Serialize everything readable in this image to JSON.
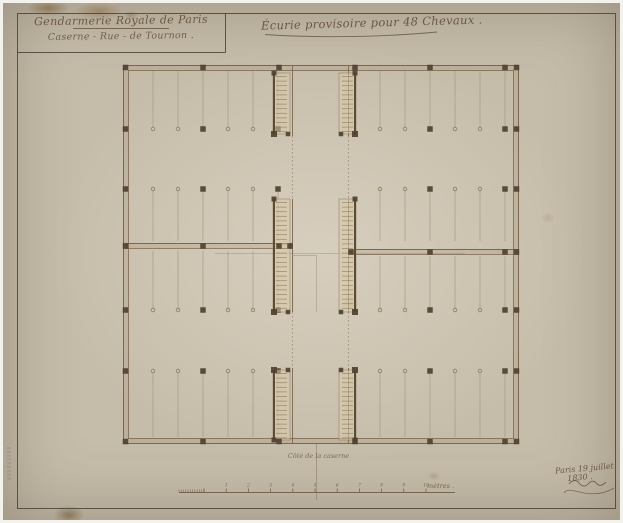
{
  "titleblock": {
    "line1": "Gendarmerie Royale de Paris",
    "line2": "Caserne - Rue - de Tournon ."
  },
  "title": "Écurie provisoire pour 48 Chevaux .",
  "plan_label": "Côté de la caserne",
  "scalebar": {
    "labels": [
      "1",
      "2",
      "3",
      "4",
      "5",
      "6",
      "7",
      "8",
      "9",
      "10"
    ],
    "unit": "mètres ."
  },
  "footer": {
    "date_line1": "Paris 19 juillet",
    "date_line2": "1830 ."
  },
  "colors": {
    "paper": "#c6bcaa",
    "ink": "#6a5841",
    "wall_line": "#7b6750",
    "stall_line": "#a5977e",
    "pier": "#4f4130",
    "frame": "#494236",
    "wash": "rgba(145,118,78,0.16)",
    "ladder_fill": "rgba(215,202,170,0.55)",
    "red_accent": "#b4674f"
  },
  "plan": {
    "frame": {
      "x1": 14.5,
      "y1": 10.5,
      "x2": 612.5,
      "y2": 505.5
    },
    "titleblock_box": {
      "vx": 222.5,
      "hy": 49.5
    },
    "title_swash": "M262,31.5 C318,35.5 388,33.5 434,29",
    "outer": {
      "x": 120.5,
      "y": 62.5,
      "w": 395,
      "h": 378,
      "t": 5
    },
    "mid_bands": [
      {
        "x1": 120.5,
        "x2": 289.5,
        "y": 240.5,
        "t": 5
      },
      {
        "x1": 345.5,
        "x2": 515.5,
        "y": 246.5,
        "t": 5
      }
    ],
    "corridor_x": [
      289.5,
      345.5
    ],
    "corridor_solid": [
      [
        62.5,
        133
      ],
      [
        196,
        309
      ],
      [
        365,
        440.5
      ]
    ],
    "corridor_dotted": [
      [
        133,
        196
      ],
      [
        309,
        365
      ]
    ],
    "center_steps": [
      [
        289.5,
        252.5,
        313.5,
        252.5
      ],
      [
        313.5,
        252.5,
        313.5,
        309
      ]
    ],
    "centerline": {
      "x": 313.5,
      "segs": [
        [
          441,
          497
        ]
      ]
    },
    "red_lines": [
      {
        "x1": 212,
        "y1": 250.5,
        "x2": 462,
        "y2": 250.5,
        "o": 0.45
      },
      {
        "x1": 289.8,
        "y1": 247,
        "x2": 289.8,
        "y2": 309,
        "o": 0.3
      }
    ],
    "quadrants": [
      {
        "xs": [
          150,
          175,
          200,
          225,
          250,
          275
        ],
        "pier_idx": [
          2,
          5
        ],
        "rows": [
          {
            "ya": 68,
            "yf": 126
          },
          {
            "ya": 238,
            "yf": 186
          }
        ]
      },
      {
        "xs": [
          377,
          402,
          427,
          452,
          477,
          502
        ],
        "pier_idx": [
          2,
          5
        ],
        "rows": [
          {
            "ya": 68,
            "yf": 126
          },
          {
            "ya": 238,
            "yf": 186
          }
        ]
      },
      {
        "xs": [
          150,
          175,
          200,
          225,
          250,
          275
        ],
        "pier_idx": [
          2,
          5
        ],
        "rows": [
          {
            "ya": 248,
            "yf": 307
          },
          {
            "ya": 434,
            "yf": 368
          }
        ]
      },
      {
        "xs": [
          377,
          402,
          427,
          452,
          477,
          502
        ],
        "pier_idx": [
          2,
          5
        ],
        "rows": [
          {
            "ya": 253,
            "yf": 307
          },
          {
            "ya": 434,
            "yf": 368
          }
        ]
      }
    ],
    "wall_piers": {
      "top": {
        "y": 64.5,
        "xs": [
          122.5,
          200,
          276,
          352,
          427,
          502,
          513.5
        ]
      },
      "bottom": {
        "y": 438.5,
        "xs": [
          122.5,
          200,
          276,
          352,
          427,
          502,
          513.5
        ]
      },
      "left": {
        "x": 122.5,
        "ys": [
          126,
          186,
          243,
          307,
          368
        ]
      },
      "right": {
        "x": 513.5,
        "ys": [
          126,
          186,
          249,
          307,
          368
        ]
      },
      "mid_left": {
        "y": 243,
        "xs": [
          200,
          276,
          287
        ]
      },
      "mid_right": {
        "y": 249,
        "xs": [
          348,
          427,
          502
        ]
      }
    },
    "ladders": [
      {
        "x": 270,
        "y1": 70,
        "y2": 131,
        "rail": "left",
        "feet": "y2"
      },
      {
        "x": 336,
        "y1": 70,
        "y2": 131,
        "rail": "right",
        "feet": "y2"
      },
      {
        "x": 270,
        "y1": 196,
        "y2": 309,
        "rail": "left",
        "feet": "y2"
      },
      {
        "x": 336,
        "y1": 196,
        "y2": 309,
        "rail": "right",
        "feet": "y2"
      },
      {
        "x": 270,
        "y1": 367,
        "y2": 437,
        "rail": "left",
        "feet": "y1"
      },
      {
        "x": 336,
        "y1": 367,
        "y2": 437,
        "rail": "right",
        "feet": "y1"
      }
    ],
    "ladder_w": 17,
    "scale": {
      "x0": 176,
      "x1": 452,
      "y": 489.5,
      "fine_x1": 201,
      "tick_step": 22.2,
      "n_ticks": 10
    },
    "signature": {
      "squiggle": "M566,481 c4,-5 8,-4 10,-1 c3,4 7,4 10,0 c3,-3 6,-2 8,1 c2,2 5,2 9,-2",
      "swash": "M561,490 c3,-5 10,-2 20,0 c12,2 22,0 30,-5"
    },
    "stamp": {
      "x": 4,
      "y": 444,
      "n": 9
    }
  }
}
